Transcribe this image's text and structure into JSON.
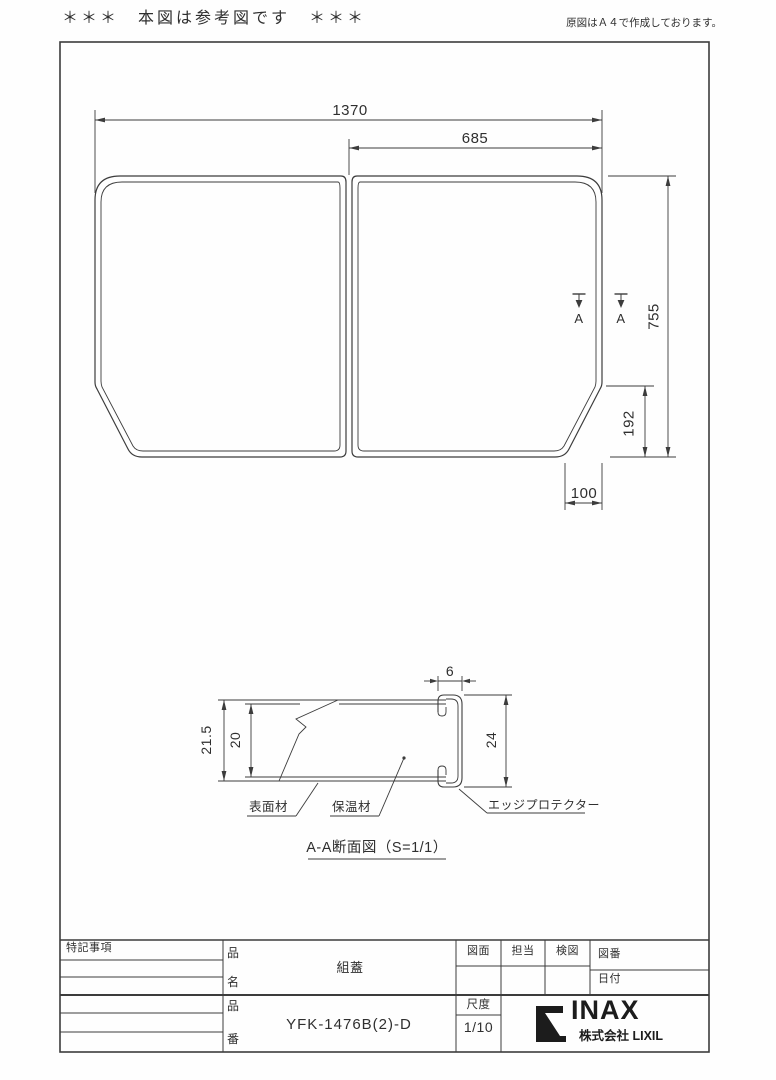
{
  "header": {
    "left_note": "＊＊＊　本図は参考図です　＊＊＊",
    "right_note": "原図はＡ４で作成しております。"
  },
  "plan_view": {
    "dims": {
      "overall_width": "1370",
      "half_width": "685",
      "overall_depth": "755",
      "chamfer_depth": "192",
      "chamfer_width": "100"
    },
    "section_marker": "A"
  },
  "section_view": {
    "dims": {
      "outer_thickness": "21.5",
      "core_thickness": "20",
      "edge_width": "6",
      "edge_height": "24"
    },
    "labels": {
      "surface": "表面材",
      "insulation": "保温材",
      "edge_protector": "エッジプロテクター"
    },
    "title": "A-A断面図（S=1/1）"
  },
  "title_block": {
    "notes_label": "特記事項",
    "label_item": "品",
    "label_name": "名",
    "label_number": "番",
    "product_name": "組蓋",
    "product_number": "YFK-1476B(2)-D",
    "drawing_label": "図面",
    "staff_label": "担当",
    "check_label": "検図",
    "drawing_no_label": "図番",
    "date_label": "日付",
    "scale_label": "尺度",
    "scale_value": "1/10",
    "brand": "INAX",
    "company": "株式会社 LIXIL"
  },
  "colors": {
    "line": "#3c3c3c",
    "text": "#2f2f2f"
  }
}
